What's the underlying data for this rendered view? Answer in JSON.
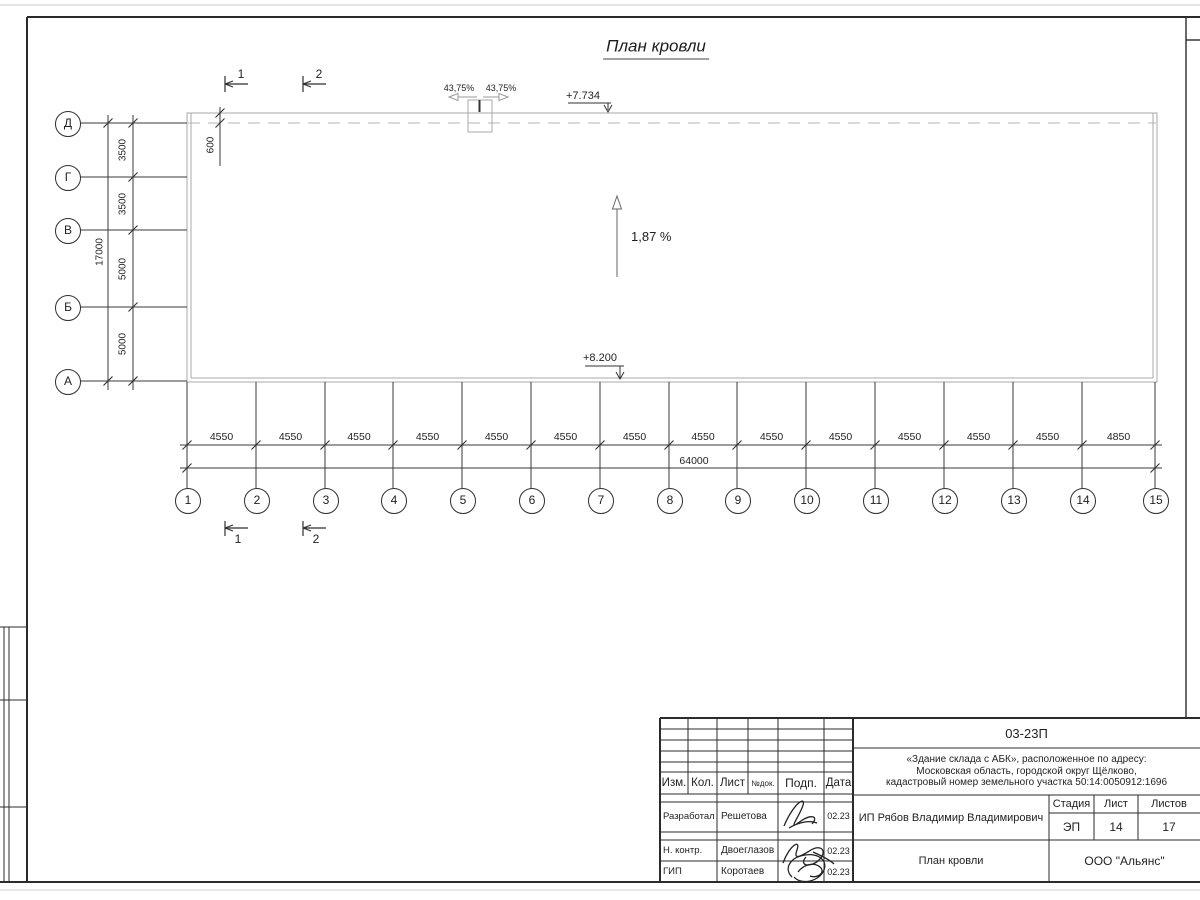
{
  "page": {
    "title": "План кровли"
  },
  "plan": {
    "slope": "1,87 %",
    "elev_top": "+7.734",
    "elev_bottom": "+8.200",
    "vent_slope_left": "43,75%",
    "vent_slope_right": "43,75%",
    "overhang": "600"
  },
  "axes": {
    "rows": [
      "Д",
      "Г",
      "В",
      "Б",
      "А"
    ],
    "row_dims": [
      "3500",
      "3500",
      "5000",
      "5000"
    ],
    "row_total": "17000",
    "cols": [
      "1",
      "2",
      "3",
      "4",
      "5",
      "6",
      "7",
      "8",
      "9",
      "10",
      "11",
      "12",
      "13",
      "14",
      "15"
    ],
    "col_dims": [
      "4550",
      "4550",
      "4550",
      "4550",
      "4550",
      "4550",
      "4550",
      "4550",
      "4550",
      "4550",
      "4550",
      "4550",
      "4550",
      "4850"
    ],
    "col_total": "64000"
  },
  "section_marks": {
    "top": [
      "1",
      "2"
    ],
    "bottom": [
      "1",
      "2"
    ]
  },
  "title_block": {
    "doc_number": "03-23П",
    "project_line1": "«Здание склада с АБК», расположенное по адресу:",
    "project_line2": "Московская область, городской округ Щёлково,",
    "project_line3": "кадастровый номер земельного участка 50:14:0050912:1696",
    "cols": {
      "izm": "Изм.",
      "kol": "Кол.",
      "list": "Лист",
      "ndok": "№док.",
      "podp": "Подп.",
      "data": "Дата"
    },
    "signers": [
      {
        "role": "Разработал",
        "name": "Решетова",
        "date": "02.23"
      },
      {
        "role": "Н. контр.",
        "name": "Двоеглазов",
        "date": "02.23"
      },
      {
        "role": "ГИП",
        "name": "Коротаев",
        "date": "02.23"
      }
    ],
    "client": "ИП Рябов Владимир Владимирович",
    "stage_label": "Стадия",
    "sheet_label": "Лист",
    "sheets_label": "Листов",
    "stage": "ЭП",
    "sheet_no": "14",
    "sheets_total": "17",
    "drawing_name": "План кровли",
    "company": "ООО \"Альянс\""
  }
}
